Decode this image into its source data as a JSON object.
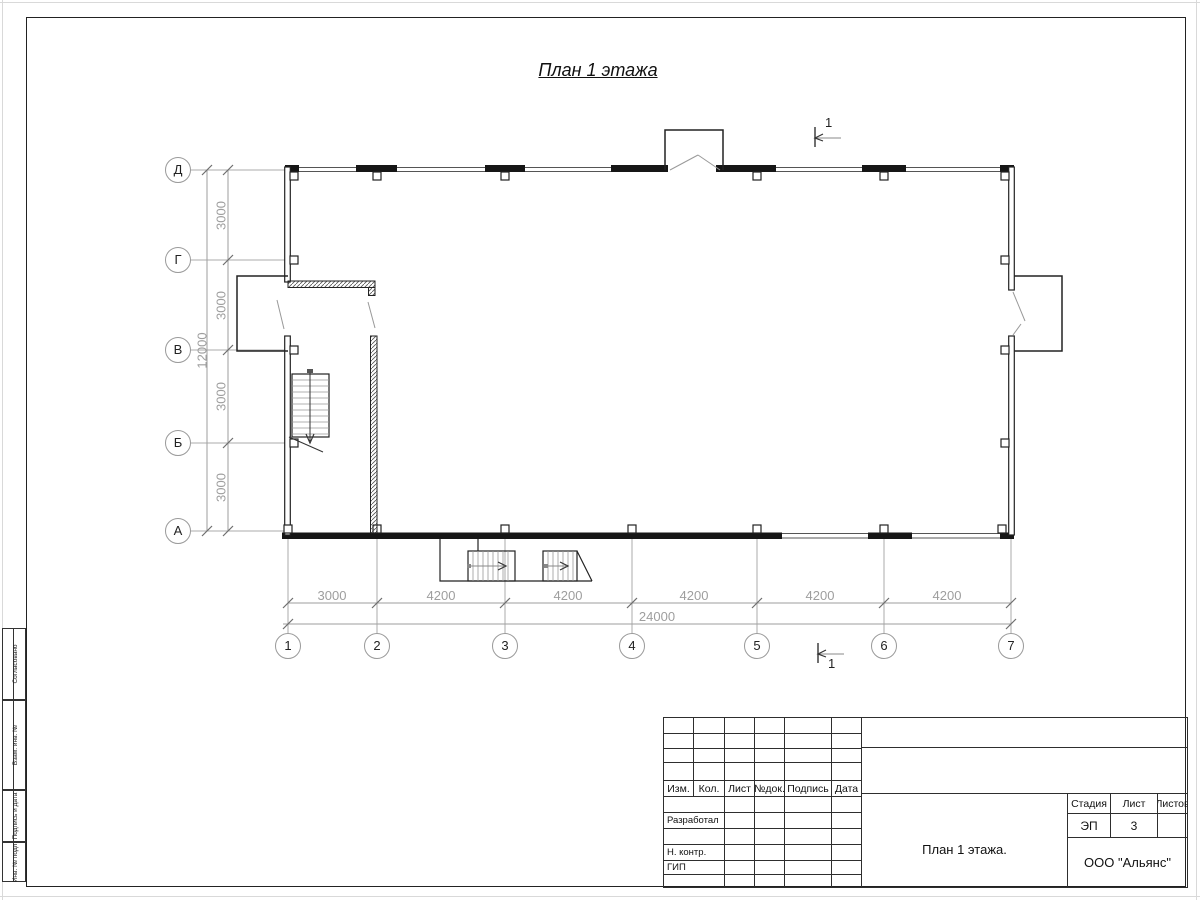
{
  "page": {
    "title": "План 1 этажа"
  },
  "section_marks": {
    "top_label": "1",
    "bottom_label": "1"
  },
  "axes": {
    "rows": [
      {
        "label": "Д"
      },
      {
        "label": "Г"
      },
      {
        "label": "В"
      },
      {
        "label": "Б"
      },
      {
        "label": "А"
      }
    ],
    "cols": [
      {
        "label": "1"
      },
      {
        "label": "2"
      },
      {
        "label": "3"
      },
      {
        "label": "4"
      },
      {
        "label": "5"
      },
      {
        "label": "6"
      },
      {
        "label": "7"
      }
    ]
  },
  "dimensions": {
    "v_segments": [
      {
        "value": "3000"
      },
      {
        "value": "3000"
      },
      {
        "value": "3000"
      },
      {
        "value": "3000"
      }
    ],
    "v_total": "12000",
    "h_segments": [
      {
        "value": "3000"
      },
      {
        "value": "4200"
      },
      {
        "value": "4200"
      },
      {
        "value": "4200"
      },
      {
        "value": "4200"
      },
      {
        "value": "4200"
      }
    ],
    "h_total": "24000"
  },
  "side_strip": {
    "cells": [
      {
        "label": "Согласовано"
      },
      {
        "label": "Взам. инв. №"
      },
      {
        "label": "Подпись и дата"
      },
      {
        "label": "Инв. № подл."
      }
    ]
  },
  "title_block": {
    "change_header": {
      "izm": "Изм.",
      "kol": "Кол.",
      "list": "Лист",
      "doc": "№док.",
      "sign": "Подпись",
      "date": "Дата"
    },
    "roles": [
      {
        "label": "Разработал"
      },
      {
        "label": "Н. контр."
      },
      {
        "label": "ГИП"
      }
    ],
    "stage_header": "Стадия",
    "sheet_header": "Лист",
    "sheets_header": "Листов",
    "stage_value": "ЭП",
    "sheet_value": "3",
    "sheets_value": "",
    "doc_title": "План 1 этажа.",
    "company": "ООО \"Альянс\""
  },
  "colors": {
    "wall": "#1c1c1c",
    "grid": "#ababab",
    "dim_text": "#9e9e9e",
    "text": "#1a1a1a"
  }
}
